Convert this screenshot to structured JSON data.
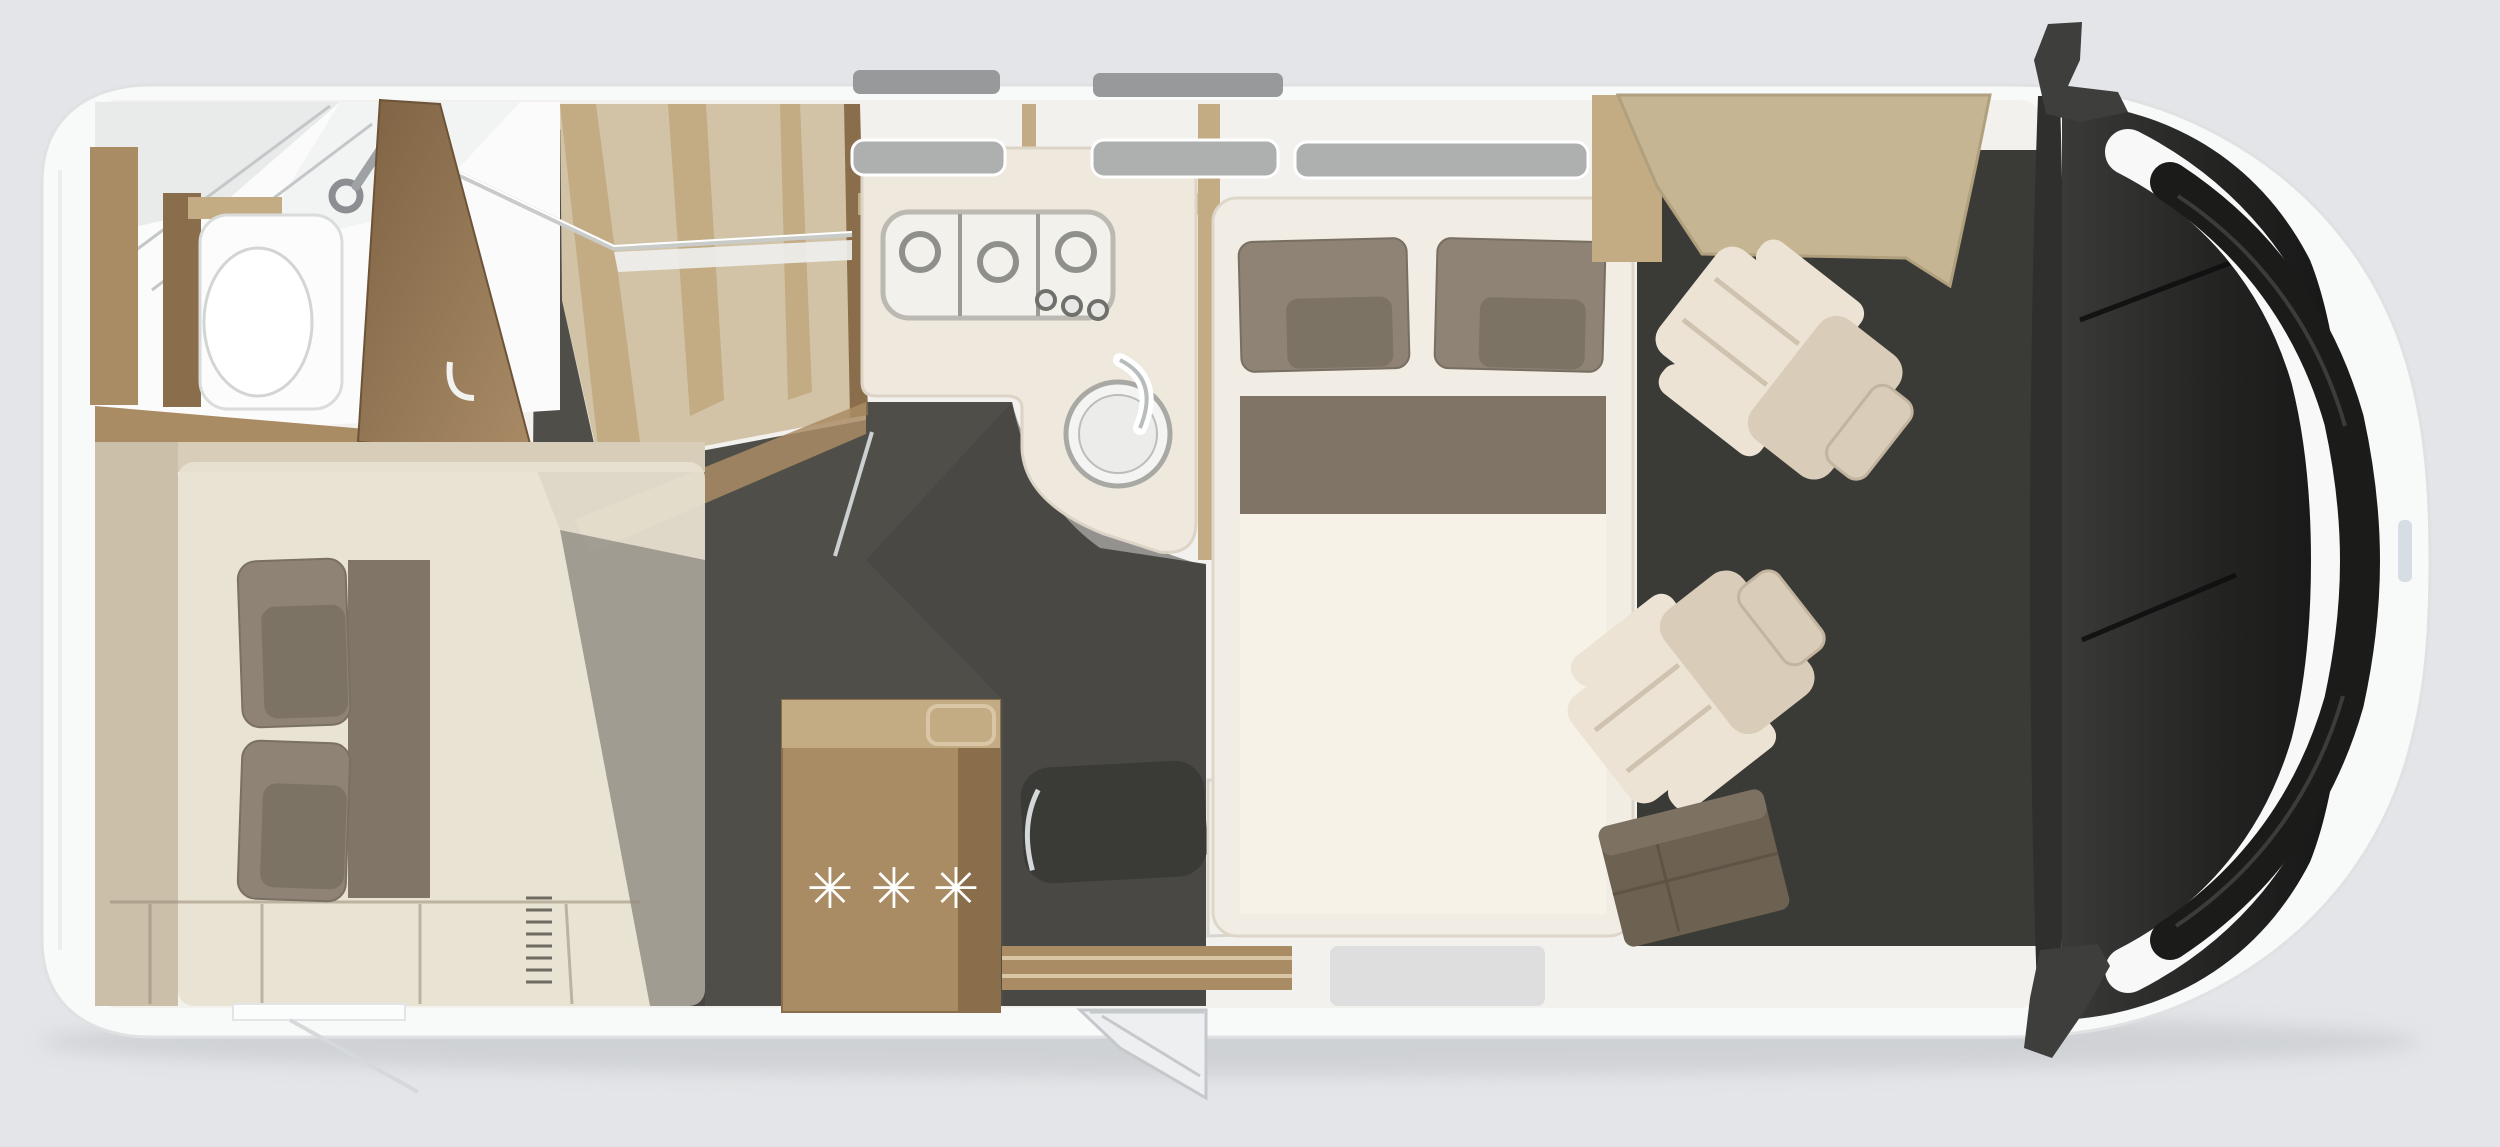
{
  "meta": {
    "title": "Motorhome floor plan - top view",
    "view": "plan",
    "vehicle": "motorhome with rear bathroom, wardrobe, kitchen, island bed and swivel cab seats"
  },
  "fridge": {
    "symbol": "✳",
    "symbol_count": 3
  },
  "regions": [
    {
      "id": "bathroom",
      "items": [
        "toilet",
        "shower-tray",
        "shower-head"
      ]
    },
    {
      "id": "wardrobe",
      "items": [
        "open-door",
        "hanging-rod",
        "dividers"
      ]
    },
    {
      "id": "kitchen",
      "items": [
        "stove-3-burner",
        "control-knobs",
        "round-sink",
        "faucet"
      ]
    },
    {
      "id": "rear-bed",
      "items": [
        "two-pillows",
        "runner",
        "under-bed-storage"
      ]
    },
    {
      "id": "fridge-cabinet",
      "items": [
        "freezer-symbols"
      ]
    },
    {
      "id": "entry",
      "items": [
        "door",
        "threshold",
        "step"
      ]
    },
    {
      "id": "island-bed",
      "items": [
        "two-large-pillows",
        "two-small-pillows",
        "blanket-band"
      ]
    },
    {
      "id": "cab",
      "items": [
        "overcab-shelf",
        "driver-seat",
        "passenger-seat",
        "bench",
        "dashboard",
        "windshield",
        "grille",
        "mirrors"
      ]
    }
  ],
  "colors": {
    "bg": "#e3e5e8",
    "body": "#f8f9f9",
    "bodyedge": "#dfe1e2",
    "interior": "#f3f1ed",
    "wood": "#a98c64",
    "wooddark": "#8a6d4b",
    "wooddeep": "#7c5f40",
    "woodlight": "#c3ab84",
    "woodpale": "#d2c3a6",
    "tanshelf": "#c6b593",
    "floor": "#504e49",
    "floordark": "#3a3a37",
    "mattress": "#e8e1d1",
    "bedhead": "#d8cdb8",
    "benchwall": "#cbbfa9",
    "pillow": "#8e8374",
    "pillowdark": "#7d7365",
    "runner": "#807566",
    "bedframe": "#f2ede4",
    "bedwhite": "#f7f2e8",
    "blanket": "#7f7466",
    "seat": "#d9cdb9",
    "seatlight": "#ece3d4",
    "bench": "#6d6152",
    "benchlight": "#7d7162",
    "glass": "#232322",
    "dash": "#2f2f2d",
    "grille": "#1b1b1a",
    "metal": "#98999b",
    "slot": "#aeb0b0",
    "silver": "#cdd0d2",
    "mat": "#d3d5d6",
    "step": "#edeff0",
    "shadow": "#c0c3c7",
    "porcelain": "#fafbfa",
    "trayline": "#c3c7c9"
  }
}
